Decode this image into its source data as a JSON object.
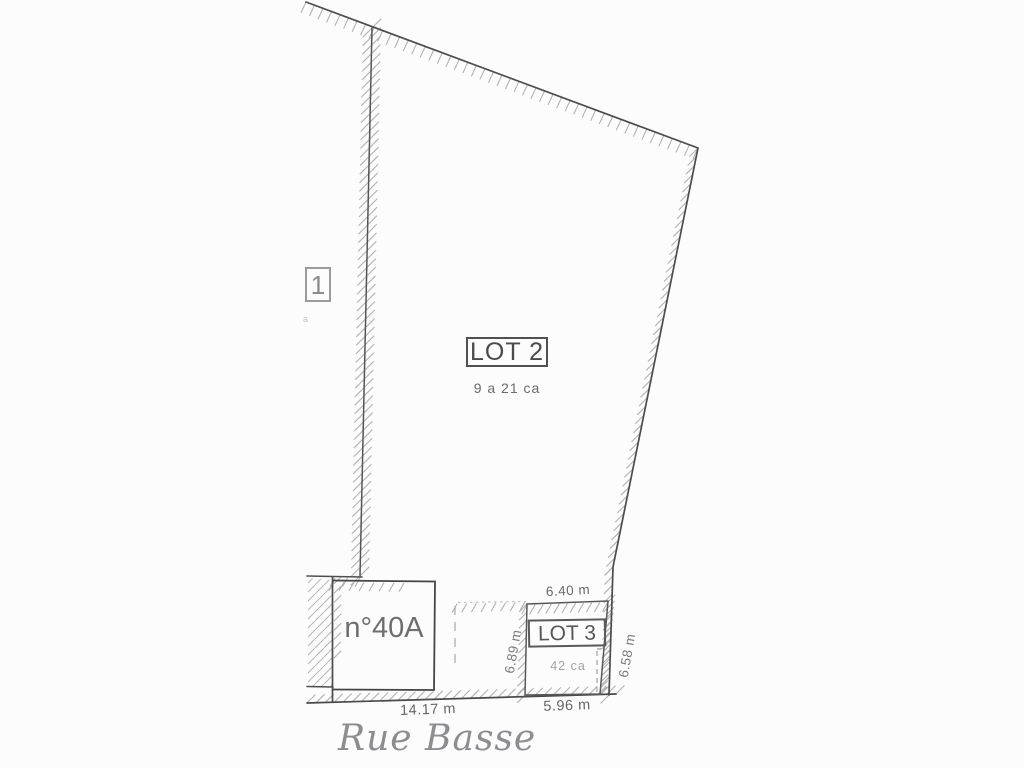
{
  "plan": {
    "lot1": {
      "label": "1",
      "area_fragment": "a"
    },
    "lot2": {
      "label": "LOT 2",
      "area": "9 a 21 ca"
    },
    "lot3": {
      "label": "LOT 3",
      "area": "42 ca"
    },
    "building": {
      "label": "n°40A"
    },
    "street": {
      "name": "Rue Basse"
    },
    "dimensions": {
      "lot3_top": "6.40 m",
      "lot3_west": "6.89 m",
      "lot3_east": "6.58 m",
      "lot3_south": "5.96 m",
      "frontage": "14.17 m"
    },
    "colors": {
      "boundary_line": "#4c4c4c",
      "hatch": "#b2b2b2",
      "dashed_line": "#a5a5a5",
      "label_text": "#565656",
      "faint_text": "#a2a2a2",
      "street_text": "#8d8d91",
      "background": "#fcfcfc"
    }
  }
}
